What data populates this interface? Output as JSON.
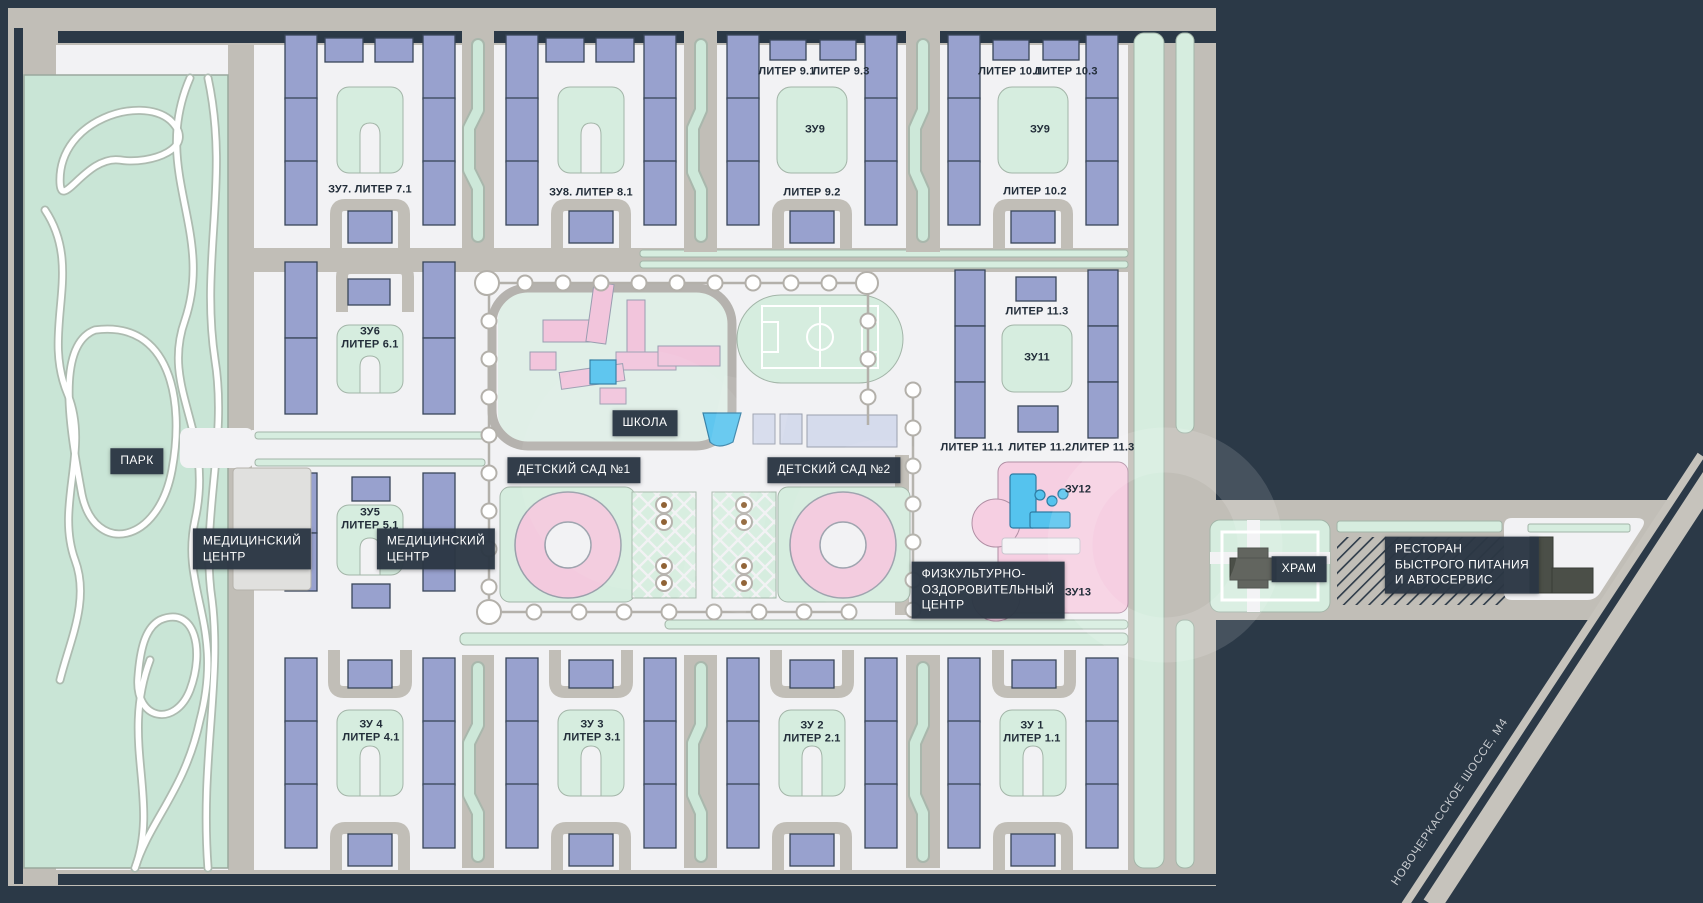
{
  "map_title": "Масштабный план жилого комплекса",
  "colors": {
    "background": "#2b3947",
    "road": "#c1beb7",
    "plot": "#f2f2f4",
    "green": "#d6eddf",
    "park_green": "#c9e5d6",
    "residential_building": "#98a1ce",
    "social_building_pink": "#f2c5dc",
    "pool_blue": "#55c3ee",
    "dark_building": "#4b4f48",
    "label_box": "#2b3744"
  },
  "labels": {
    "park": "ПАРК",
    "school": "ШКОЛА",
    "kindergarten_1": "ДЕТСКИЙ САД №1",
    "kindergarten_2": "ДЕТСКИЙ САД №2",
    "medical_center_lines": [
      "МЕДИЦИНСКИЙ",
      "ЦЕНТР"
    ],
    "fitness_lines": [
      "ФИЗКУЛЬТУРНО-",
      "ОЗДОРОВИТЕЛЬНЫЙ",
      "ЦЕНТР"
    ],
    "temple": "ХРАМ",
    "restaurant_lines": [
      "РЕСТОРАН",
      "БЫСТРОГО ПИТАНИЯ",
      "И АВТОСЕРВИС"
    ],
    "highway": "НОВОЧЕРКАССКОЕ ШОССЕ, М4"
  },
  "plots": {
    "zu7": "ЗУ7. ЛИТЕР 7.1",
    "zu8": "ЗУ8. ЛИТЕР 8.1",
    "liter_9_1": "ЛИТЕР 9.1",
    "liter_9_3": "ЛИТЕР 9.3",
    "zu9_left": "ЗУ9",
    "liter_9_2": "ЛИТЕР 9.2",
    "liter_10_1": "ЛИТЕР 10.1",
    "liter_10_3": "ЛИТЕР 10.3",
    "zu9_right": "ЗУ9",
    "liter_10_2": "ЛИТЕР 10.2",
    "zu6_lines": [
      "ЗУ6",
      "ЛИТЕР 6.1"
    ],
    "zu5_lines": [
      "ЗУ5",
      "ЛИТЕР 5.1"
    ],
    "liter_11_3_top": "ЛИТЕР 11.3",
    "zu11": "ЗУ11",
    "liter_11_1": "ЛИТЕР 11.1",
    "liter_11_2": "ЛИТЕР 11.2",
    "liter_11_3": "ЛИТЕР 11.3",
    "zu12": "ЗУ12",
    "zu13": "ЗУ13",
    "zu4_lines": [
      "ЗУ 4",
      "ЛИТЕР 4.1"
    ],
    "zu3_lines": [
      "ЗУ 3",
      "ЛИТЕР 3.1"
    ],
    "zu2_lines": [
      "ЗУ 2",
      "ЛИТЕР 2.1"
    ],
    "zu1_lines": [
      "ЗУ 1",
      "ЛИТЕР 1.1"
    ]
  }
}
